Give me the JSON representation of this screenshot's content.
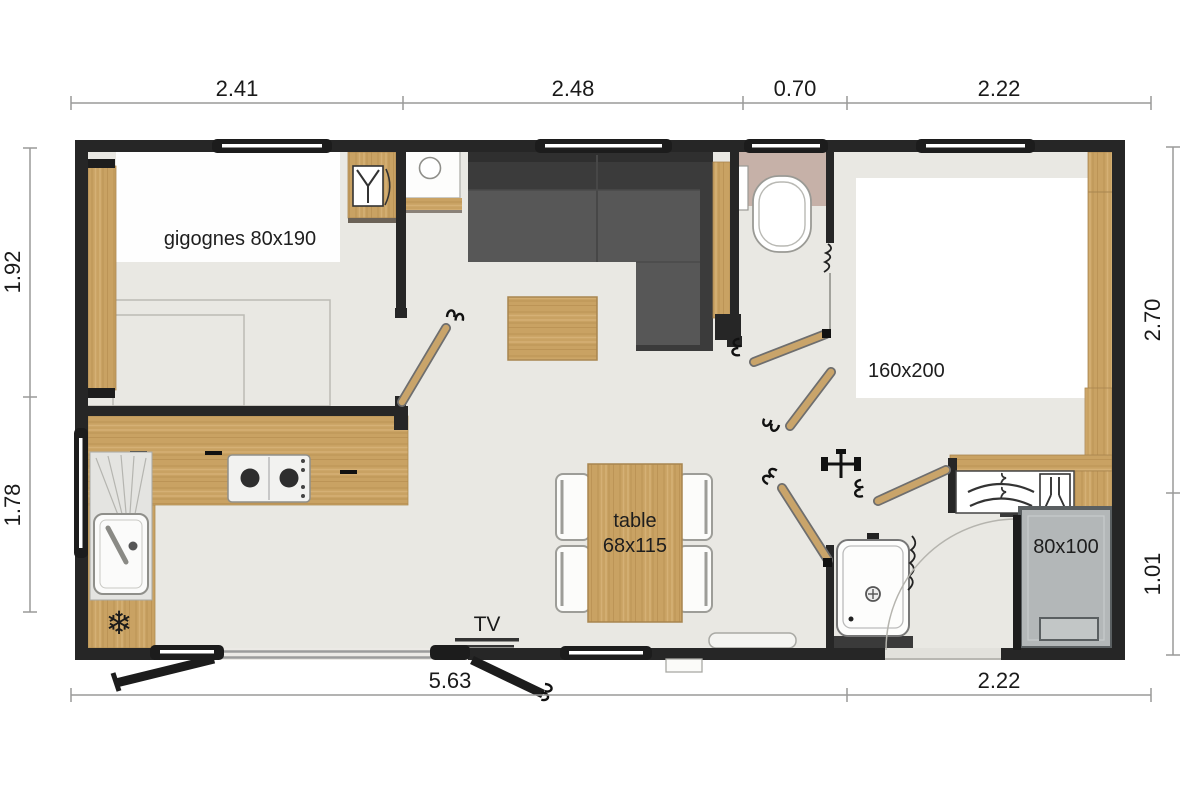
{
  "dimensions": {
    "top": [
      "2.41",
      "2.48",
      "0.70",
      "2.22"
    ],
    "bottom": [
      "5.63",
      "2.22"
    ],
    "left": [
      "1.92",
      "1.78"
    ],
    "right": [
      "2.70",
      "1.01"
    ]
  },
  "labels": {
    "small_bedroom_beds": "gigognes 80x190",
    "master_bed": "160x200",
    "table_line1": "table",
    "table_line2": "68x115",
    "tv": "TV",
    "shower": "80x100"
  },
  "glyphs": {
    "fridge": "❄"
  },
  "icons": [
    "snowflake-icon",
    "stove-icon",
    "kitchen-sink-icon",
    "toilet-icon",
    "washbasin-icon",
    "boiler-icon",
    "hangers-icon",
    "water-heater-icon",
    "desk-chair-icon",
    "door-leaf-icon",
    "window-icon",
    "coat-rack-icon"
  ],
  "colors": {
    "wall": "#262626",
    "floor": "#e9e8e3",
    "wood": "#c9a263",
    "wood_edge": "#a8854f",
    "sofa_back": "#3b3b3b",
    "sofa_seat": "#575757",
    "wc_floor": "#c6b1a8",
    "shower_fill": "#b3b7b8",
    "shower_frame": "#5a5f61",
    "dim_line": "#9a9a99",
    "text": "#1a1a1a"
  }
}
